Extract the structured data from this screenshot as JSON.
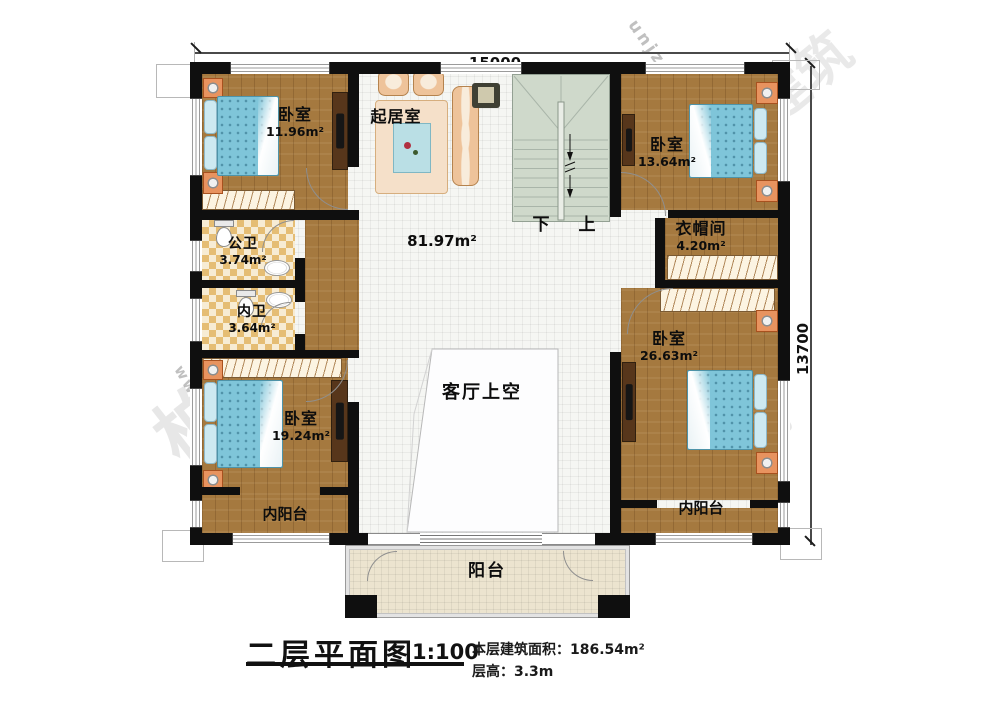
{
  "dimensions": {
    "width": "15000",
    "height": "13700"
  },
  "rooms": {
    "bedroom_tl": {
      "name": "卧室",
      "area": "11.96m²"
    },
    "living": {
      "name": "起居室"
    },
    "hall": {
      "area": "81.97m²"
    },
    "stairs": {
      "down": "下",
      "up": "上"
    },
    "bedroom_tr": {
      "name": "卧室",
      "area": "13.64m²"
    },
    "cloakroom": {
      "name": "衣帽间",
      "area": "4.20m²"
    },
    "bath_public": {
      "name": "公卫",
      "area": "3.74m²"
    },
    "bath_private": {
      "name": "内卫",
      "area": "3.64m²"
    },
    "bedroom_bl": {
      "name": "卧室",
      "area": "19.24m²"
    },
    "bedroom_br": {
      "name": "卧室",
      "area": "26.63m²"
    },
    "void": {
      "name": "客厅上空"
    },
    "inner_balcony_left": {
      "name": "内阳台"
    },
    "inner_balcony_right": {
      "name": "内阳台"
    },
    "balcony": {
      "name": "阳台"
    }
  },
  "title_block": {
    "title": "二层平面图",
    "scale": "1:100",
    "area_label": "本层建筑面积：",
    "area_value": "186.54m²",
    "height_label": "层高：",
    "height_value": "3.3m"
  },
  "watermark": {
    "brand": "柏筑建筑",
    "url_fragment": "unjz.com",
    "www_fragment": "www.b"
  },
  "colors": {
    "wall": "#0f0f0f",
    "wood_floor": "#a5793f",
    "bed": "#7fc5d9",
    "stairs": "#cfd9cb",
    "bath_tile": "#e5bd74",
    "balcony": "#ece4cf"
  }
}
